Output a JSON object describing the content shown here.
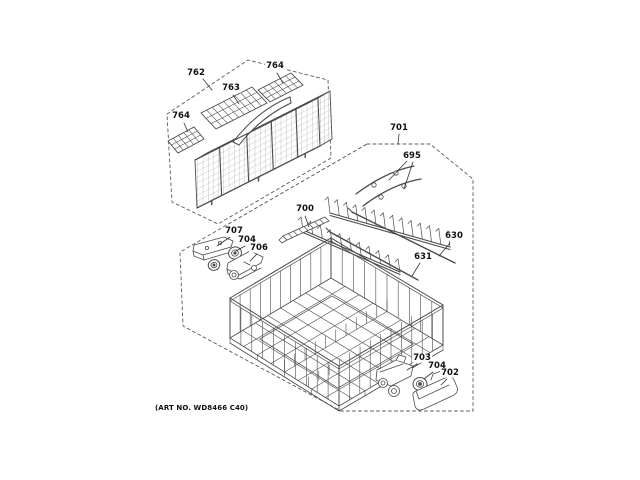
{
  "figure": {
    "art_no": "(ART NO. WD8466 C40)",
    "colors": {
      "background": "#ffffff",
      "line": "#4b4b4b",
      "label": "#111111",
      "boundary": "#5a5a5a"
    }
  },
  "callouts": [
    {
      "part": "762",
      "text": "762"
    },
    {
      "part": "763",
      "text": "763"
    },
    {
      "part": "764",
      "text": "764"
    },
    {
      "part": "764",
      "text": "764"
    },
    {
      "part": "701",
      "text": "701"
    },
    {
      "part": "695",
      "text": "695"
    },
    {
      "part": "700",
      "text": "700"
    },
    {
      "part": "707",
      "text": "707"
    },
    {
      "part": "704",
      "text": "704"
    },
    {
      "part": "706",
      "text": "706"
    },
    {
      "part": "630",
      "text": "630"
    },
    {
      "part": "631",
      "text": "631"
    },
    {
      "part": "703",
      "text": "703"
    },
    {
      "part": "704",
      "text": "704"
    },
    {
      "part": "702",
      "text": "702"
    }
  ]
}
